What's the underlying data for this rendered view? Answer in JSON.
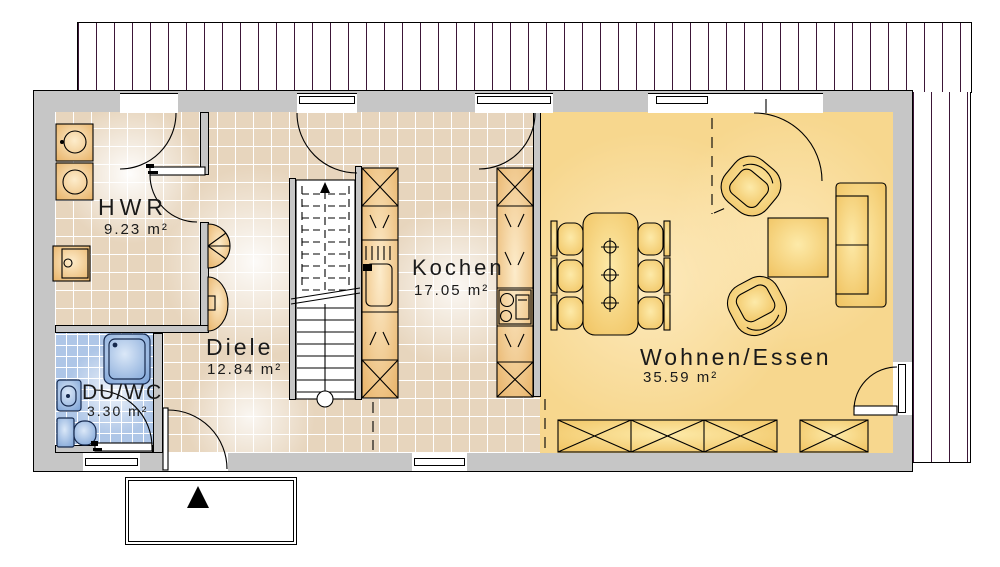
{
  "plan": {
    "type": "floor-plan-ground-floor",
    "rooms": [
      {
        "name": "HWR",
        "area": "9.23 m²"
      },
      {
        "name": "DU/WC",
        "area": "3.30 m²"
      },
      {
        "name": "Diele",
        "area": "12.84 m²"
      },
      {
        "name": "Kochen",
        "area": "17.05 m²"
      },
      {
        "name": "Wohnen/Essen",
        "area": "35.59 m²"
      }
    ]
  },
  "colors": {
    "wall": "#c6c6c6",
    "outline": "#000000",
    "tile-beige": "#e7d5bd",
    "grout": "#ffffff",
    "floor-gold": "#f7d78e",
    "tile-blue": "#aec6e7",
    "furn-warm": "#eec27e",
    "furn-gold": "#f6cf74",
    "fixture-blue": "#9db9e2",
    "hatch-line": "#3c1637",
    "text": "#1a1a1a"
  }
}
